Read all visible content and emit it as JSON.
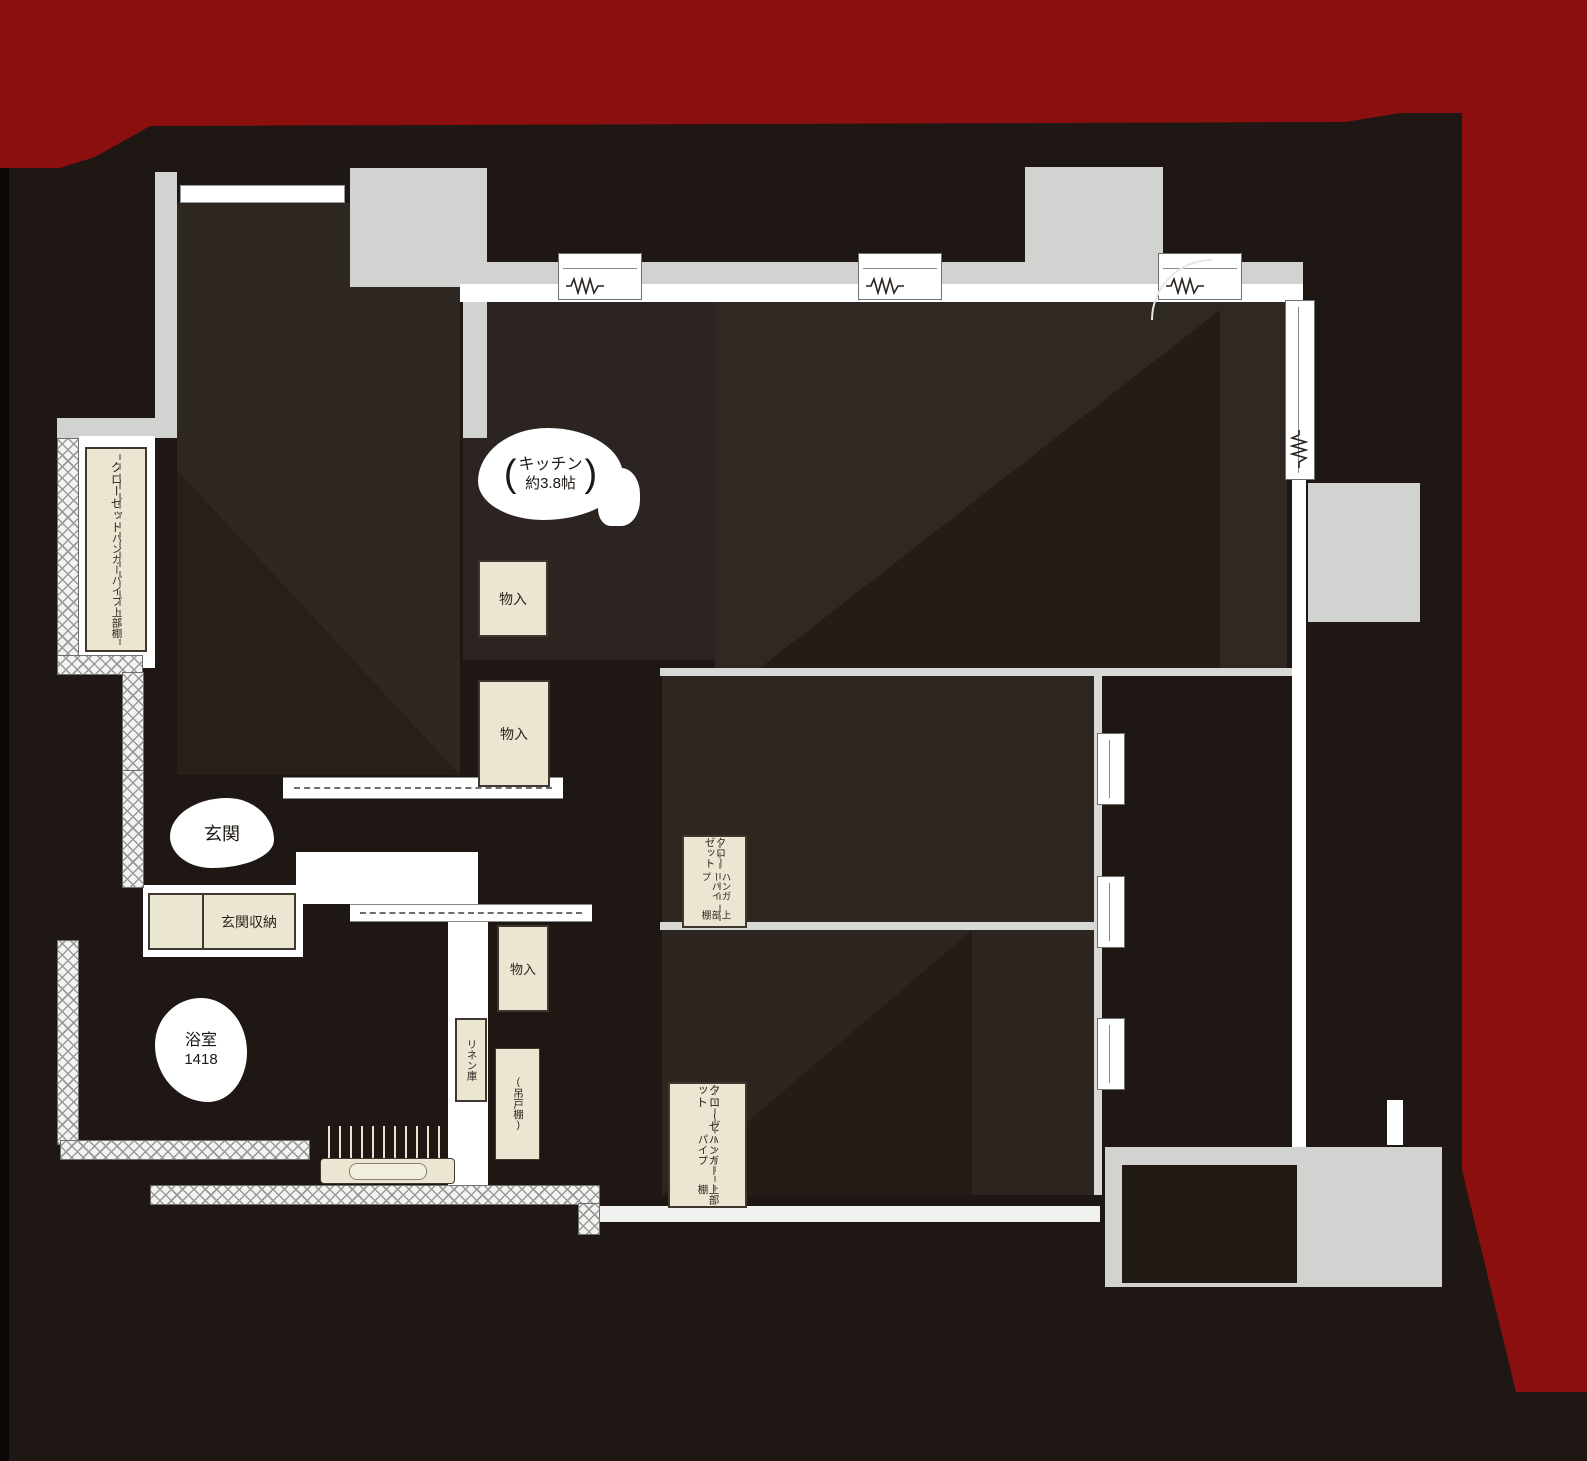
{
  "plan_title": "apartment-floor-plan",
  "colors": {
    "accent_red": "#8c0f0f",
    "wall_gray": "#d2d2d1",
    "fixture_cream": "#ebe6d2",
    "floor_dark": "#2e2721",
    "base_dark": "#1e1713"
  },
  "rooms": {
    "kitchen": {
      "paren_open": "(",
      "name": "キッチン",
      "size": "約3.8帖",
      "paren_close": ")"
    },
    "entrance": {
      "name": "玄関"
    },
    "entrance_storage": {
      "name": "玄関収納"
    },
    "bathroom": {
      "name": "浴室",
      "size": "1418"
    },
    "storage_a": {
      "name": "物入"
    },
    "storage_b": {
      "name": "物入"
    },
    "storage_c": {
      "name": "物入"
    },
    "linen_closet": {
      "name": "リネン庫"
    },
    "hanging_cupboard": {
      "paren_open": "(",
      "name": "吊戸棚",
      "paren_close": ")"
    },
    "closet_northwest": {
      "name": "クローゼット",
      "feature": "ハンガーパイプ",
      "shelf": "上部棚"
    },
    "closet_center": {
      "name": "クローゼット",
      "feature": "ハンガーパイプ",
      "shelf": "上部棚"
    },
    "closet_south": {
      "name": "クローゼット",
      "feature": "ハンガーパイプ",
      "shelf": "上部棚"
    }
  }
}
